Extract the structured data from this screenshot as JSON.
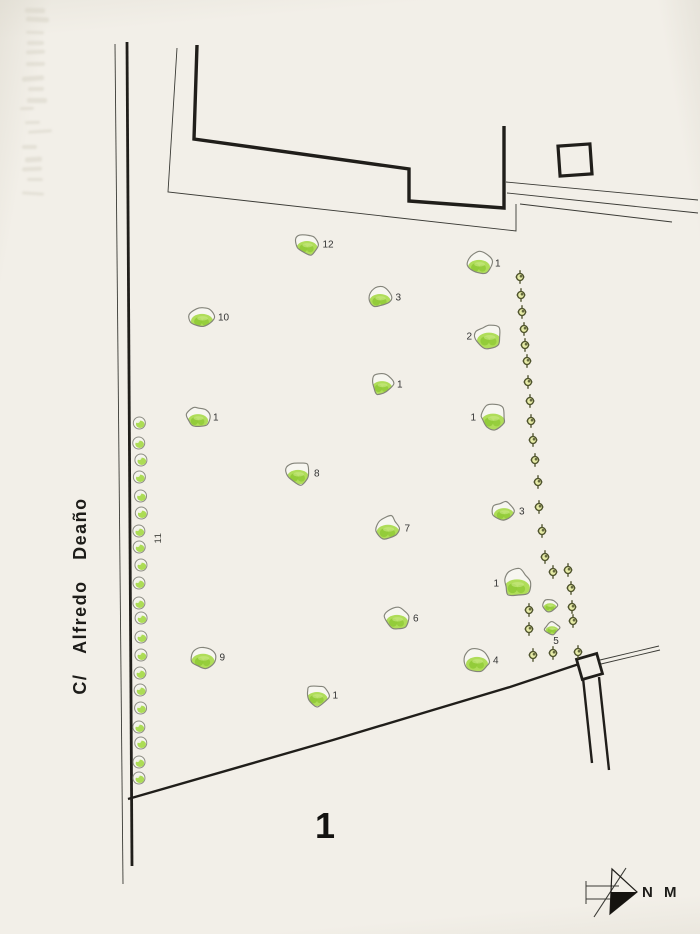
{
  "labels": {
    "street": "C/ Alfredo  Deaño",
    "zone": "1",
    "north": "N M",
    "tree_row": "11",
    "cluster": "5"
  },
  "colors": {
    "paper": "#f2efe8",
    "ink": "#201e1a",
    "thin_line": "#3a3a35",
    "tree_stroke": "#84847a",
    "tree_green": "#a8da4c",
    "tree_green_dark": "#8cc832",
    "tree_green_light": "#c9e986",
    "cross_stroke": "#4e522c",
    "cross_fill": "#e6eba6",
    "label": "#333333"
  },
  "plan": {
    "trees": [
      {
        "x": 307,
        "y": 244,
        "w": 23,
        "label": "12",
        "side": "right"
      },
      {
        "x": 380,
        "y": 297,
        "w": 23,
        "label": "3",
        "side": "right"
      },
      {
        "x": 202,
        "y": 317,
        "w": 24,
        "label": "10",
        "side": "right"
      },
      {
        "x": 382,
        "y": 384,
        "w": 22,
        "label": "1",
        "side": "right"
      },
      {
        "x": 198,
        "y": 417,
        "w": 22,
        "label": "1",
        "side": "right"
      },
      {
        "x": 479,
        "y": 263,
        "w": 24,
        "label": "1",
        "side": "right"
      },
      {
        "x": 489,
        "y": 336,
        "w": 26,
        "label": "2",
        "side": "left"
      },
      {
        "x": 493,
        "y": 417,
        "w": 26,
        "label": "1",
        "side": "left"
      },
      {
        "x": 298,
        "y": 473,
        "w": 24,
        "label": "8",
        "side": "right"
      },
      {
        "x": 388,
        "y": 528,
        "w": 25,
        "label": "7",
        "side": "right"
      },
      {
        "x": 504,
        "y": 511,
        "w": 22,
        "label": "3",
        "side": "right"
      },
      {
        "x": 517,
        "y": 583,
        "w": 28,
        "label": "1",
        "side": "left"
      },
      {
        "x": 397,
        "y": 618,
        "w": 24,
        "label": "6",
        "side": "right"
      },
      {
        "x": 203,
        "y": 657,
        "w": 25,
        "label": "9",
        "side": "right"
      },
      {
        "x": 477,
        "y": 660,
        "w": 24,
        "label": "4",
        "side": "right"
      },
      {
        "x": 317,
        "y": 695,
        "w": 23,
        "label": "1",
        "side": "right"
      }
    ],
    "small_trees": [
      {
        "x": 550,
        "y": 605,
        "w": 14
      },
      {
        "x": 552,
        "y": 628,
        "w": 14
      }
    ],
    "crosses": [
      [
        520,
        277
      ],
      [
        521,
        295
      ],
      [
        522,
        312
      ],
      [
        524,
        329
      ],
      [
        525,
        345
      ],
      [
        527,
        361
      ],
      [
        528,
        382
      ],
      [
        530,
        401
      ],
      [
        531,
        421
      ],
      [
        533,
        440
      ],
      [
        535,
        460
      ],
      [
        538,
        482
      ],
      [
        539,
        507
      ],
      [
        542,
        531
      ],
      [
        545,
        557
      ],
      [
        553,
        572
      ],
      [
        568,
        570
      ],
      [
        571,
        588
      ],
      [
        572,
        607
      ],
      [
        573,
        621
      ],
      [
        578,
        652
      ],
      [
        529,
        610
      ],
      [
        529,
        629
      ],
      [
        533,
        655
      ],
      [
        553,
        653
      ]
    ],
    "shrub_row": {
      "x": 140,
      "ys": [
        423,
        443,
        460,
        477,
        496,
        513,
        531,
        547,
        565,
        583,
        603,
        618,
        637,
        655,
        673,
        690,
        708,
        727,
        743,
        762,
        778
      ]
    },
    "label_positions": {
      "street": {
        "x": 80,
        "y": 596
      },
      "zone": {
        "x": 325,
        "y": 838
      },
      "north": {
        "x": 642,
        "y": 897
      },
      "tree_row": {
        "x": 158,
        "y": 538
      },
      "cluster": {
        "x": 556,
        "y": 644
      }
    }
  }
}
